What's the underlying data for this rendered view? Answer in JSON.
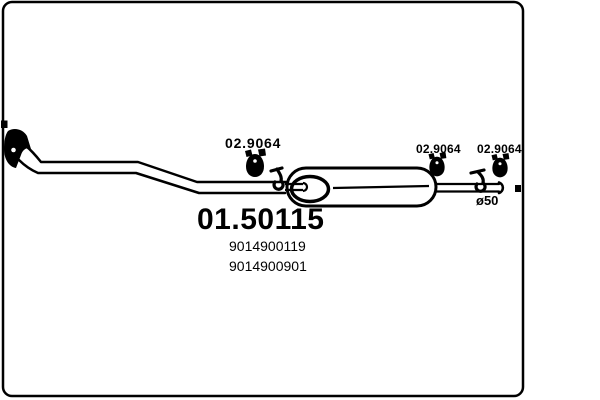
{
  "diagram": {
    "part_number": "01.50115",
    "oem_numbers": [
      "9014900119",
      "9014900901"
    ],
    "clamp_labels": [
      "02.9064",
      "02.9064",
      "02.9064"
    ],
    "diameter_label": "ø50",
    "colors": {
      "line": "#000000",
      "background": "#ffffff"
    }
  }
}
